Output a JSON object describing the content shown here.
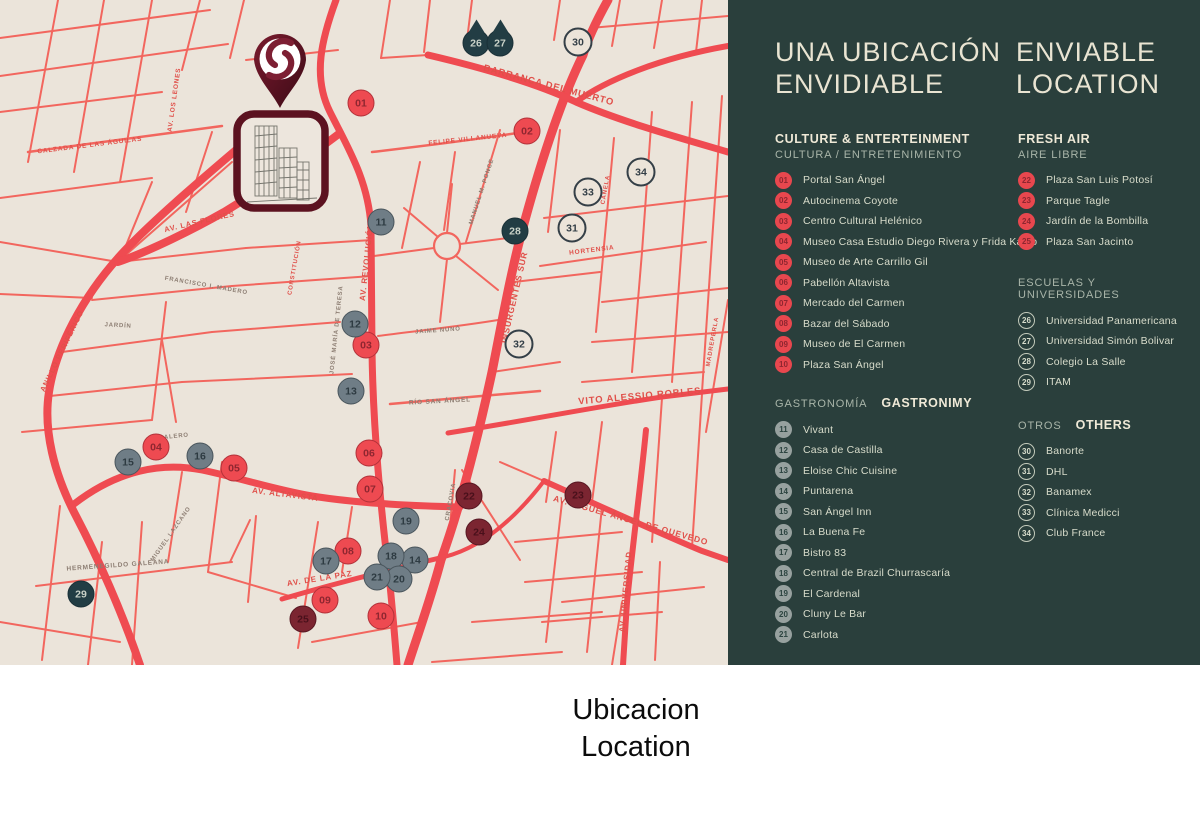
{
  "panel": {
    "title": {
      "es_line1": "UNA UBICACIÓN",
      "es_line2": "ENVIDIABLE",
      "en_line1": "ENVIABLE",
      "en_line2": "LOCATION"
    },
    "colors": {
      "panel_bg": "#2a3f3c",
      "accent_red": "#e8474e",
      "cream": "#e9e4d2"
    },
    "columns": [
      {
        "sections": [
          {
            "id": "culture",
            "layout": "stacked",
            "badge": "red",
            "header_primary": "CULTURE & ENTERTEINMENT",
            "header_secondary": "CULTURA / ENTRETENIMIENTO",
            "items": [
              {
                "num": "01",
                "label": "Portal San Ángel"
              },
              {
                "num": "02",
                "label": "Autocinema Coyote"
              },
              {
                "num": "03",
                "label": "Centro Cultural Helénico"
              },
              {
                "num": "04",
                "label": "Museo Casa Estudio Diego Rivera y Frida Kahlo"
              },
              {
                "num": "05",
                "label": "Museo de Arte Carrillo Gil"
              },
              {
                "num": "06",
                "label": "Pabellón Altavista"
              },
              {
                "num": "07",
                "label": "Mercado del Carmen"
              },
              {
                "num": "08",
                "label": "Bazar del Sábado"
              },
              {
                "num": "09",
                "label": "Museo de El Carmen"
              },
              {
                "num": "10",
                "label": "Plaza San Ángel"
              }
            ]
          },
          {
            "id": "gastronomy",
            "layout": "inline",
            "badge": "gray",
            "header_primary": "GASTRONIMY",
            "header_secondary": "GASTRONOMÍA",
            "items": [
              {
                "num": "11",
                "label": "Vivant"
              },
              {
                "num": "12",
                "label": "Casa de Castilla"
              },
              {
                "num": "13",
                "label": "Eloise Chic Cuisine"
              },
              {
                "num": "14",
                "label": "Puntarena"
              },
              {
                "num": "15",
                "label": "San Ángel Inn"
              },
              {
                "num": "16",
                "label": "La Buena Fe"
              },
              {
                "num": "17",
                "label": "Bistro 83"
              },
              {
                "num": "18",
                "label": "Central de Brazil Churrascaría"
              },
              {
                "num": "19",
                "label": "El Cardenal"
              },
              {
                "num": "20",
                "label": "Cluny Le Bar"
              },
              {
                "num": "21",
                "label": "Carlota"
              }
            ]
          }
        ]
      },
      {
        "sections": [
          {
            "id": "fresh-air",
            "layout": "stacked",
            "badge": "red",
            "header_primary": "FRESH AIR",
            "header_secondary": "AIRE LIBRE",
            "items": [
              {
                "num": "22",
                "label": "Plaza San Luis Potosí"
              },
              {
                "num": "23",
                "label": "Parque Tagle"
              },
              {
                "num": "24",
                "label": "Jardín de la Bombilla"
              },
              {
                "num": "25",
                "label": "Plaza San Jacinto"
              }
            ]
          },
          {
            "id": "schools",
            "layout": "secondary-only",
            "badge": "ring",
            "header_primary": "",
            "header_secondary": "ESCUELAS Y UNIVERSIDADES",
            "items": [
              {
                "num": "26",
                "label": "Universidad Panamericana"
              },
              {
                "num": "27",
                "label": "Universidad Simón Bolivar"
              },
              {
                "num": "28",
                "label": "Colegio La Salle"
              },
              {
                "num": "29",
                "label": "ITAM"
              }
            ]
          },
          {
            "id": "others",
            "layout": "inline",
            "badge": "ring",
            "header_primary": "OTHERS",
            "header_secondary": "OTROS",
            "items": [
              {
                "num": "30",
                "label": "Banorte"
              },
              {
                "num": "31",
                "label": "DHL"
              },
              {
                "num": "32",
                "label": "Banamex"
              },
              {
                "num": "33",
                "label": "Clínica Medicci"
              },
              {
                "num": "34",
                "label": "Club France"
              }
            ]
          }
        ]
      }
    ]
  },
  "caption": {
    "line1": "Ubicacion",
    "line2": "Location"
  },
  "map": {
    "colors": {
      "bg": "#ebe4da",
      "road": "#f2665e",
      "road_major": "#ef4b51",
      "marker_red": "#ee4a51",
      "marker_gray": "#6f7d86",
      "marker_maroon": "#7b2531",
      "marker_teal": "#223d44",
      "marker_outline": "#ece4d9",
      "pin_maroon": "#5c1220"
    },
    "markers": [
      {
        "num": "01",
        "x": 361,
        "y": 103,
        "kind": "red"
      },
      {
        "num": "02",
        "x": 527,
        "y": 131,
        "kind": "red"
      },
      {
        "num": "03",
        "x": 366,
        "y": 345,
        "kind": "red"
      },
      {
        "num": "04",
        "x": 156,
        "y": 447,
        "kind": "red"
      },
      {
        "num": "05",
        "x": 234,
        "y": 468,
        "kind": "red"
      },
      {
        "num": "06",
        "x": 369,
        "y": 453,
        "kind": "red"
      },
      {
        "num": "07",
        "x": 370,
        "y": 489,
        "kind": "red"
      },
      {
        "num": "08",
        "x": 348,
        "y": 551,
        "kind": "red"
      },
      {
        "num": "09",
        "x": 325,
        "y": 600,
        "kind": "red"
      },
      {
        "num": "10",
        "x": 381,
        "y": 616,
        "kind": "red"
      },
      {
        "num": "11",
        "x": 381,
        "y": 222,
        "kind": "gray"
      },
      {
        "num": "12",
        "x": 355,
        "y": 324,
        "kind": "gray"
      },
      {
        "num": "13",
        "x": 351,
        "y": 391,
        "kind": "gray"
      },
      {
        "num": "14",
        "x": 415,
        "y": 560,
        "kind": "gray"
      },
      {
        "num": "15",
        "x": 128,
        "y": 462,
        "kind": "gray"
      },
      {
        "num": "16",
        "x": 200,
        "y": 456,
        "kind": "gray"
      },
      {
        "num": "17",
        "x": 326,
        "y": 561,
        "kind": "gray"
      },
      {
        "num": "18",
        "x": 391,
        "y": 556,
        "kind": "gray"
      },
      {
        "num": "19",
        "x": 406,
        "y": 521,
        "kind": "gray"
      },
      {
        "num": "20",
        "x": 399,
        "y": 579,
        "kind": "gray"
      },
      {
        "num": "21",
        "x": 377,
        "y": 577,
        "kind": "gray"
      },
      {
        "num": "22",
        "x": 469,
        "y": 496,
        "kind": "maroon"
      },
      {
        "num": "23",
        "x": 578,
        "y": 495,
        "kind": "maroon"
      },
      {
        "num": "24",
        "x": 479,
        "y": 532,
        "kind": "maroon"
      },
      {
        "num": "25",
        "x": 303,
        "y": 619,
        "kind": "maroon"
      },
      {
        "num": "26",
        "x": 476,
        "y": 43,
        "kind": "tree"
      },
      {
        "num": "27",
        "x": 500,
        "y": 43,
        "kind": "tree"
      },
      {
        "num": "28",
        "x": 515,
        "y": 231,
        "kind": "teal"
      },
      {
        "num": "29",
        "x": 81,
        "y": 594,
        "kind": "teal"
      },
      {
        "num": "30",
        "x": 578,
        "y": 42,
        "kind": "outline"
      },
      {
        "num": "31",
        "x": 572,
        "y": 228,
        "kind": "outline"
      },
      {
        "num": "32",
        "x": 519,
        "y": 344,
        "kind": "outline"
      },
      {
        "num": "33",
        "x": 588,
        "y": 192,
        "kind": "outline"
      },
      {
        "num": "34",
        "x": 641,
        "y": 172,
        "kind": "outline"
      }
    ],
    "street_labels": [
      {
        "text": "CALZADA DE LAS ÁGUILAS",
        "x": 90,
        "y": 147,
        "rot": -7,
        "size": 6.5,
        "tone": "red"
      },
      {
        "text": "AV. LOS LEONES",
        "x": 176,
        "y": 100,
        "rot": -82,
        "size": 6.5,
        "tone": "red"
      },
      {
        "text": "BARRANCA DEL MUERTO",
        "x": 548,
        "y": 88,
        "rot": 15,
        "size": 9.5,
        "tone": "red"
      },
      {
        "text": "FELIPE VILLANUEVA",
        "x": 468,
        "y": 141,
        "rot": -6,
        "size": 6.5,
        "tone": "red"
      },
      {
        "text": "MANUEL M. PONCE",
        "x": 483,
        "y": 192,
        "rot": -72,
        "size": 6,
        "tone": "dark"
      },
      {
        "text": "AV. LAS FLORES",
        "x": 200,
        "y": 224,
        "rot": -13,
        "size": 7.5,
        "tone": "red"
      },
      {
        "text": "ANILLO PERIFÉRICO",
        "x": 64,
        "y": 352,
        "rot": -64,
        "size": 7.5,
        "tone": "red"
      },
      {
        "text": "FRANCISCO I. MADERO",
        "x": 206,
        "y": 287,
        "rot": 10,
        "size": 6,
        "tone": "dark"
      },
      {
        "text": "JARDÍN",
        "x": 118,
        "y": 327,
        "rot": 3,
        "size": 6,
        "tone": "dark"
      },
      {
        "text": "AV. REVOLUCIÓN",
        "x": 369,
        "y": 262,
        "rot": -84,
        "size": 8,
        "tone": "red"
      },
      {
        "text": "CONSTITUCIÓN",
        "x": 296,
        "y": 268,
        "rot": -80,
        "size": 6,
        "tone": "red"
      },
      {
        "text": "JOSÉ MARÍA DE TERESA",
        "x": 338,
        "y": 330,
        "rot": -84,
        "size": 6,
        "tone": "dark"
      },
      {
        "text": "JAIME NUNÓ",
        "x": 438,
        "y": 332,
        "rot": -4,
        "size": 6,
        "tone": "dark"
      },
      {
        "text": "INSURGENTES SUR",
        "x": 517,
        "y": 298,
        "rot": -77,
        "size": 8.5,
        "tone": "red"
      },
      {
        "text": "RÍO SAN ÁNGEL",
        "x": 440,
        "y": 403,
        "rot": -3,
        "size": 6.5,
        "tone": "dark"
      },
      {
        "text": "VITO ALESSIO ROBLES",
        "x": 640,
        "y": 399,
        "rot": -5,
        "size": 9.5,
        "tone": "red"
      },
      {
        "text": "HORTENSIA",
        "x": 592,
        "y": 252,
        "rot": -7,
        "size": 6.5,
        "tone": "red"
      },
      {
        "text": "CANELA",
        "x": 607,
        "y": 190,
        "rot": -80,
        "size": 6,
        "tone": "red"
      },
      {
        "text": "MADREPERLA",
        "x": 714,
        "y": 342,
        "rot": -80,
        "size": 6,
        "tone": "red"
      },
      {
        "text": "CALERO",
        "x": 174,
        "y": 438,
        "rot": -6,
        "size": 6,
        "tone": "dark"
      },
      {
        "text": "AV. ALTAVISTA",
        "x": 285,
        "y": 497,
        "rot": 7,
        "size": 8,
        "tone": "red"
      },
      {
        "text": "MIGUEL LAZCANO",
        "x": 172,
        "y": 535,
        "rot": -55,
        "size": 6,
        "tone": "dark"
      },
      {
        "text": "HERMENEGILDO GALEANA",
        "x": 118,
        "y": 567,
        "rot": -4,
        "size": 6.5,
        "tone": "dark"
      },
      {
        "text": "AV. DE LA PAZ",
        "x": 320,
        "y": 581,
        "rot": -9,
        "size": 8,
        "tone": "red"
      },
      {
        "text": "CRACOVIA",
        "x": 452,
        "y": 502,
        "rot": -80,
        "size": 6,
        "tone": "dark"
      },
      {
        "text": "AV. MIGUEL ÁNGEL DE QUEVEDO",
        "x": 630,
        "y": 523,
        "rot": 16,
        "size": 8.5,
        "tone": "red"
      },
      {
        "text": "AV. UNIVERSIDAD",
        "x": 628,
        "y": 592,
        "rot": -85,
        "size": 8,
        "tone": "red"
      }
    ]
  }
}
